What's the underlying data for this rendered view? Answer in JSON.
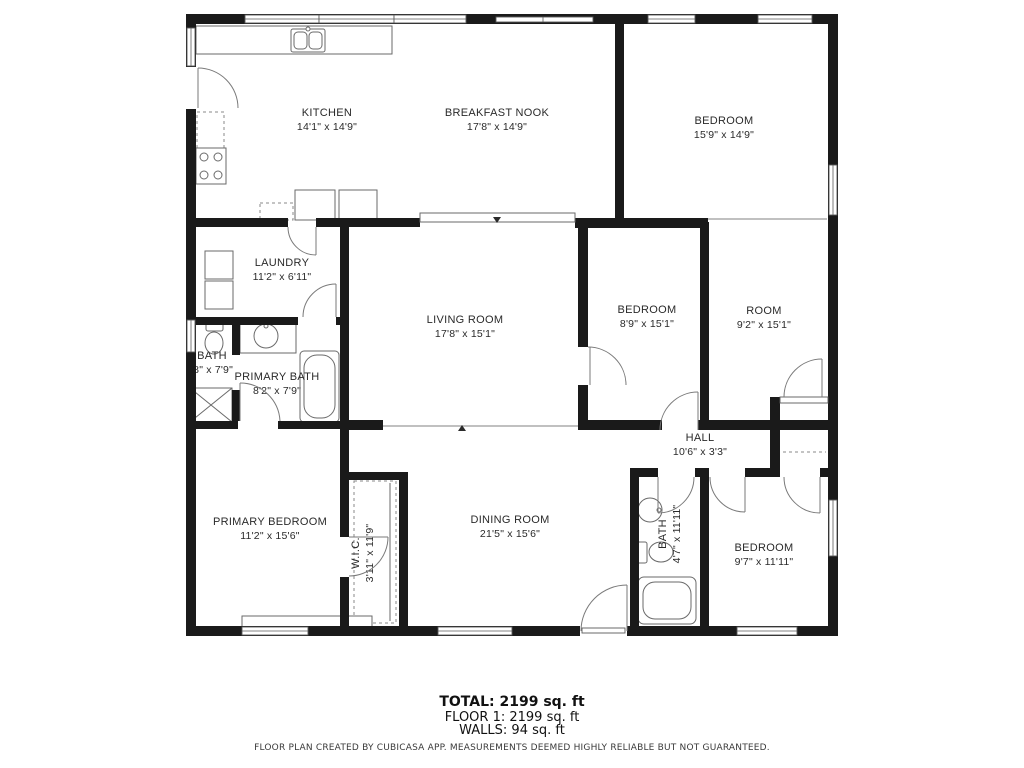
{
  "colors": {
    "wall": "#1a1a1a",
    "background": "#ffffff"
  },
  "rooms": [
    {
      "name": "KITCHEN",
      "dims": "14'1\" x 14'9\""
    },
    {
      "name": "BREAKFAST NOOK",
      "dims": "17'8\" x 14'9\""
    },
    {
      "name": "BEDROOM",
      "dims": "15'9\" x 14'9\""
    },
    {
      "name": "LAUNDRY",
      "dims": "11'2\" x 6'11\""
    },
    {
      "name": "BATH",
      "dims": "'8\" x 7'9\""
    },
    {
      "name": "PRIMARY BATH",
      "dims": "8'2\" x 7'9\""
    },
    {
      "name": "LIVING ROOM",
      "dims": "17'8\" x 15'1\""
    },
    {
      "name": "BEDROOM",
      "dims": "8'9\" x 15'1\""
    },
    {
      "name": "ROOM",
      "dims": "9'2\" x 15'1\""
    },
    {
      "name": "HALL",
      "dims": "10'6\" x 3'3\""
    },
    {
      "name": "PRIMARY BEDROOM",
      "dims": "11'2\" x 15'6\""
    },
    {
      "name": "W.I.C.",
      "dims": "3'11\" x 11'9\""
    },
    {
      "name": "DINING ROOM",
      "dims": "21'5\" x 15'6\""
    },
    {
      "name": "BATH",
      "dims": "4'7\" x 11'11\""
    },
    {
      "name": "BEDROOM",
      "dims": "9'7\" x 11'11\""
    }
  ],
  "footer": {
    "total": "TOTAL: 2199 sq. ft",
    "floor": "FLOOR 1: 2199 sq. ft",
    "walls": "WALLS: 94 sq. ft",
    "disclaimer": "FLOOR PLAN CREATED BY CUBICASA APP. MEASUREMENTS DEEMED HIGHLY RELIABLE BUT NOT GUARANTEED."
  }
}
